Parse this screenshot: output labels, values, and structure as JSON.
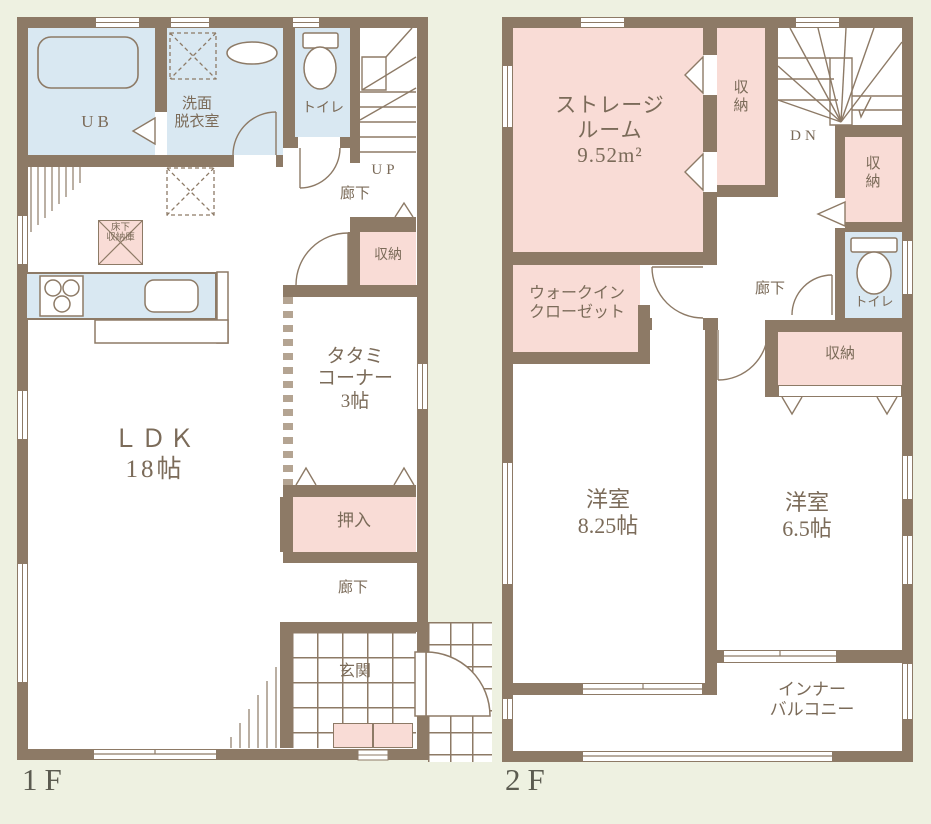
{
  "palette": {
    "background": "#eef1e1",
    "wall": "#8d7a66",
    "room_blue": "#d9e8f2",
    "room_pink": "#f9dcd6",
    "floor_white": "#ffffff",
    "label_text": "#7b6b59",
    "floor_label_text": "#5b5b50"
  },
  "floors": {
    "f1": {
      "label": "1F",
      "rooms": {
        "ub": "UB",
        "washroom": "洗面\n脱衣室",
        "toilet": "トイレ",
        "stairs_direction": "UP",
        "hallway_upper": "廊下",
        "closet": "収納",
        "underfloor_storage": "床下\n収納庫",
        "ldk": "ＬＤＫ\n18帖",
        "tatami_corner": "タタミ\nコーナー\n3帖",
        "oshiire": "押入",
        "hallway_lower": "廊下",
        "entrance": "玄関"
      }
    },
    "f2": {
      "label": "2F",
      "rooms": {
        "storage_room": "ストレージ\nルーム\n9.52m²",
        "closet_upper": "収\n納",
        "stairs_direction": "DN",
        "closet_right": "収\n納",
        "toilet": "トイレ",
        "hallway": "廊下",
        "walk_in_closet": "ウォークイン\nクローゼット",
        "closet_bedroom2": "収納",
        "bedroom1": "洋室\n8.25帖",
        "bedroom2": "洋室\n6.5帖",
        "inner_balcony": "インナー\nバルコニー"
      }
    }
  }
}
